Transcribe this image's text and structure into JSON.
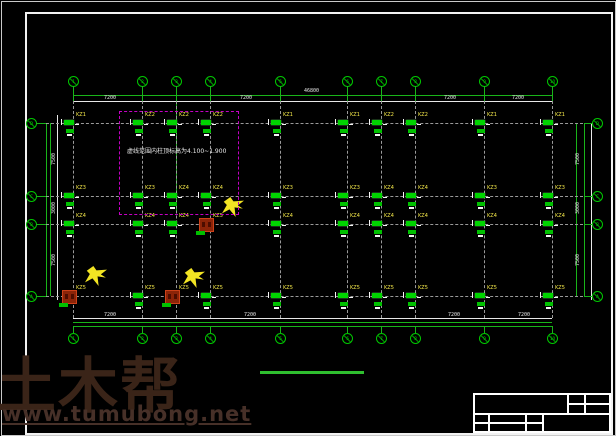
{
  "watermark": {
    "brand": "土木帮",
    "site": "www.tumubong.net"
  },
  "note": {
    "text": "虚线范围内柱顶标高为4.100~1.900"
  },
  "colors": {
    "axis_green": "#00c800",
    "dim_green": "#19b419",
    "grid_gray": "#9a9a9a",
    "label_yellow": "#f5e94a",
    "note_magenta": "#c400c4",
    "red_column": "#8c2408",
    "frame_white": "#f2f2f2",
    "underline_green": "#2fbf2f",
    "watermark_brown": "#3a2418"
  },
  "plan": {
    "v_axes": [
      {
        "x": 73,
        "label": "1"
      },
      {
        "x": 142,
        "label": "2"
      },
      {
        "x": 176,
        "label": "3"
      },
      {
        "x": 210,
        "label": "4"
      },
      {
        "x": 280,
        "label": "5"
      },
      {
        "x": 347,
        "label": "6"
      },
      {
        "x": 381,
        "label": "7"
      },
      {
        "x": 415,
        "label": "8"
      },
      {
        "x": 484,
        "label": "9"
      },
      {
        "x": 552,
        "label": "10"
      }
    ],
    "h_axes": [
      {
        "y": 123,
        "label": "D"
      },
      {
        "y": 196,
        "label": "C"
      },
      {
        "y": 224,
        "label": "B"
      },
      {
        "y": 296,
        "label": "A"
      }
    ],
    "column_rows": [
      {
        "labels": [
          "KZ1",
          "KZ2",
          "KZ2",
          "KZ2",
          "KZ1",
          "KZ1",
          "KZ2",
          "KZ2",
          "KZ1",
          "KZ1"
        ]
      },
      {
        "labels": [
          "KZ3",
          "KZ3",
          "KZ4",
          "KZ4",
          "KZ3",
          "KZ3",
          "KZ4",
          "KZ4",
          "KZ3",
          "KZ3"
        ]
      },
      {
        "labels": [
          "KZ4",
          "KZ4",
          "KZ4",
          "KZ5",
          "KZ4",
          "KZ4",
          "KZ4",
          "KZ4",
          "KZ4",
          "KZ4"
        ]
      },
      {
        "labels": [
          "KZ5",
          "KZ5",
          "KZ5",
          "KZ5",
          "KZ5",
          "KZ5",
          "KZ5",
          "KZ5",
          "KZ5",
          "KZ5"
        ]
      }
    ],
    "red_columns": [
      {
        "c": 0,
        "r": 3
      },
      {
        "c": 2,
        "r": 3
      },
      {
        "c": 3,
        "r": 2
      }
    ],
    "yellow_marks": [
      {
        "x": 85,
        "y": 266
      },
      {
        "x": 183,
        "y": 268
      },
      {
        "x": 222,
        "y": 197
      }
    ],
    "dim_texts_top": [
      {
        "x": 104,
        "y": 96,
        "t": "7200"
      },
      {
        "x": 240,
        "y": 96,
        "t": "7200"
      },
      {
        "x": 304,
        "y": 89,
        "t": "46800"
      },
      {
        "x": 444,
        "y": 96,
        "t": "7200"
      },
      {
        "x": 512,
        "y": 96,
        "t": "7200"
      }
    ],
    "dim_texts_bottom": [
      {
        "x": 104,
        "y": 313,
        "t": "7200"
      },
      {
        "x": 244,
        "y": 313,
        "t": "7200"
      },
      {
        "x": 448,
        "y": 313,
        "t": "7200"
      },
      {
        "x": 518,
        "y": 313,
        "t": "7200"
      }
    ],
    "dim_texts_left": [
      {
        "x": 52,
        "y": 165,
        "t": "7500"
      },
      {
        "x": 52,
        "y": 214,
        "t": "3000"
      },
      {
        "x": 52,
        "y": 266,
        "t": "7500"
      }
    ],
    "dim_texts_right": [
      {
        "x": 576,
        "y": 165,
        "t": "7500"
      },
      {
        "x": 576,
        "y": 214,
        "t": "3000"
      },
      {
        "x": 576,
        "y": 266,
        "t": "7500"
      }
    ],
    "note_box": {
      "x": 119,
      "y": 111,
      "w": 118,
      "h": 102
    },
    "note_text_pos": {
      "x": 127,
      "y": 148
    },
    "title_underline": {
      "x": 260,
      "y": 371,
      "w": 104
    }
  }
}
